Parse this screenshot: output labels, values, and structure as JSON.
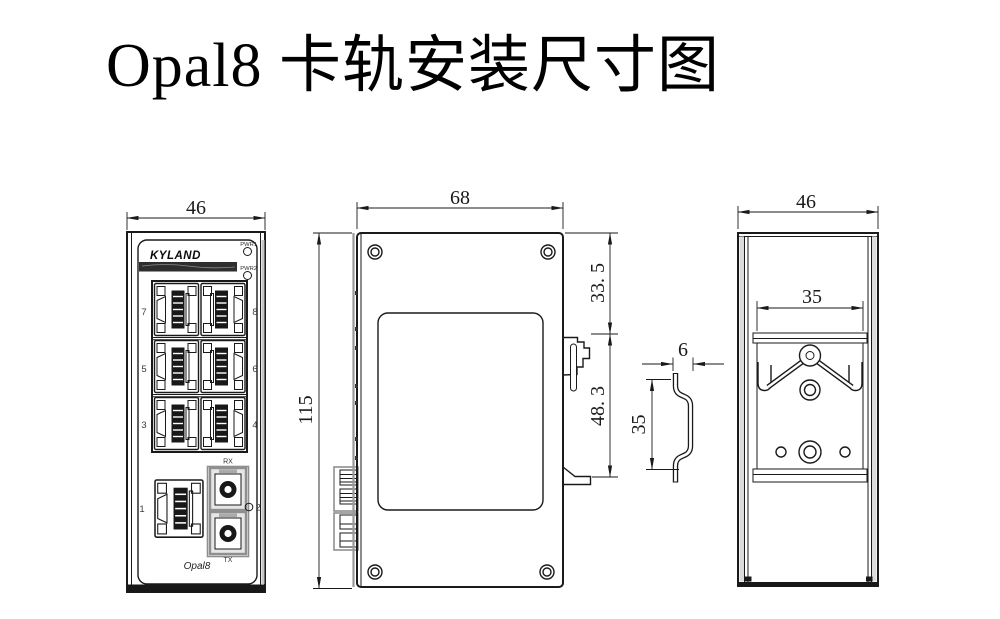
{
  "title": "Opal8 卡轨安装尺寸图",
  "colors": {
    "line": "#1a1a1a",
    "accent": "#8f8f8f",
    "dark": "#181818",
    "paper": "#ffffff"
  },
  "front_view": {
    "brand": "KYLAND",
    "model_label": "Opal8",
    "led1": "PWR1",
    "led2": "PWR2",
    "rx": "RX",
    "tx": "TX",
    "ports": {
      "p1": "1",
      "p2": "2",
      "p3": "3",
      "p4": "4",
      "p5": "5",
      "p6": "6",
      "p7": "7",
      "p8": "8"
    },
    "width_dim": "46"
  },
  "side_view": {
    "width_dim": "68",
    "height_dim": "115",
    "rail_top_offset_dim": "33. 5",
    "clip_span_dim": "48. 3"
  },
  "rail_profile": {
    "depth_dim": "6",
    "width_dim": "35"
  },
  "rear_view": {
    "width_dim": "46",
    "rail_width_dim": "35"
  }
}
